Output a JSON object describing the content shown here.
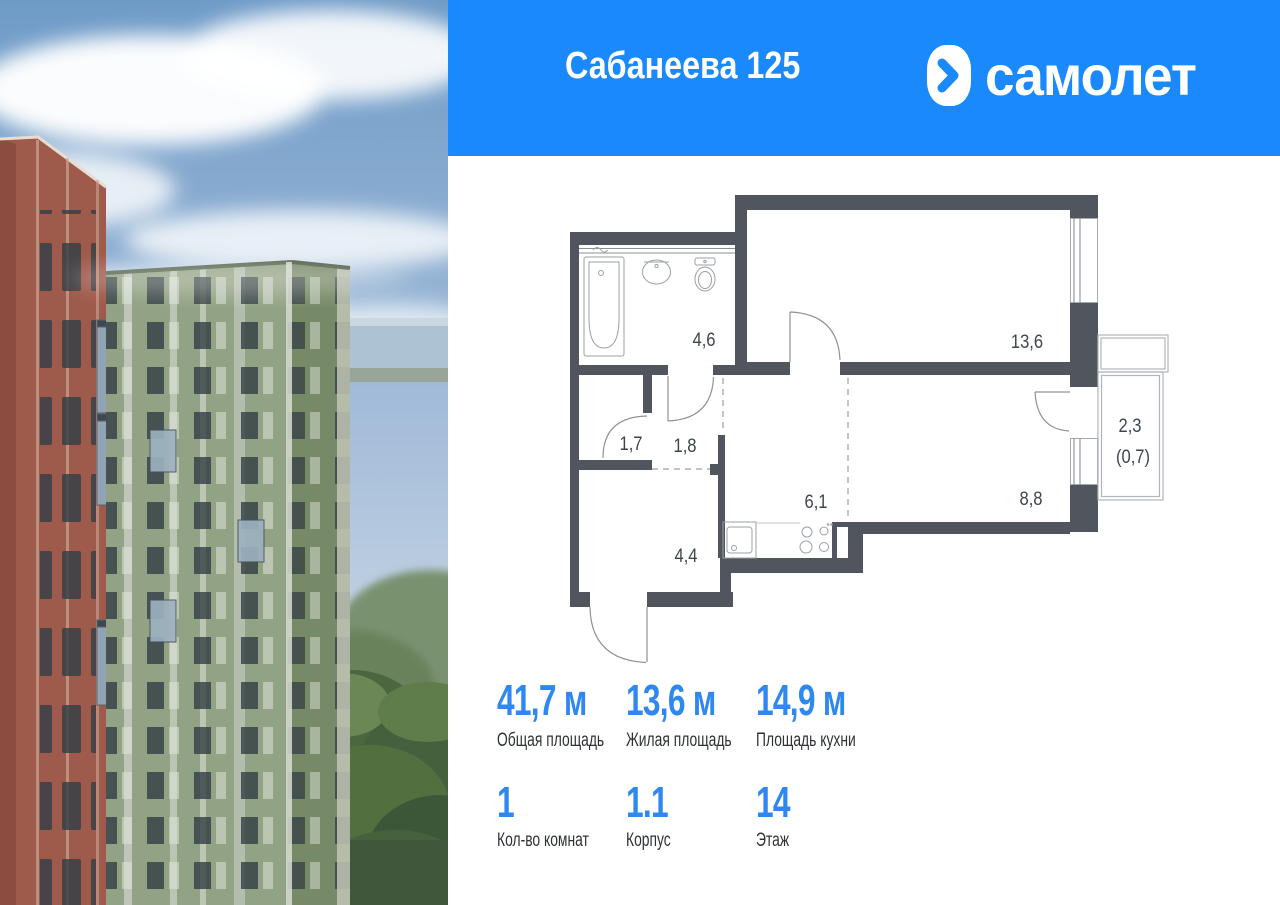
{
  "header": {
    "title": "Сабанеева 125",
    "brand": "самолет"
  },
  "floorplan": {
    "rooms": [
      {
        "id": "bathroom",
        "area": "4,6"
      },
      {
        "id": "living-room",
        "area": "13,6"
      },
      {
        "id": "wardrobe",
        "area": "1,7"
      },
      {
        "id": "hall",
        "area": "1,8"
      },
      {
        "id": "kitchen",
        "area": "6,1"
      },
      {
        "id": "room",
        "area": "8,8"
      },
      {
        "id": "hallway",
        "area": "4,4"
      },
      {
        "id": "balcony",
        "area": "2,3",
        "area_reduced": "(0,7)"
      }
    ]
  },
  "stats": {
    "row1": [
      {
        "value": "41,7 м",
        "label": "Общая площадь"
      },
      {
        "value": "13,6 м",
        "label": "Жилая площадь"
      },
      {
        "value": "14,9 м",
        "label": "Площадь кухни"
      }
    ],
    "row2": [
      {
        "value": "1",
        "label": "Кол-во комнат"
      },
      {
        "value": "1.1",
        "label": "Корпус"
      },
      {
        "value": "14",
        "label": "Этаж"
      }
    ]
  },
  "colors": {
    "header_bg": "#1989FC",
    "stat_number": "#2F87F0",
    "wall": "#51565E"
  }
}
